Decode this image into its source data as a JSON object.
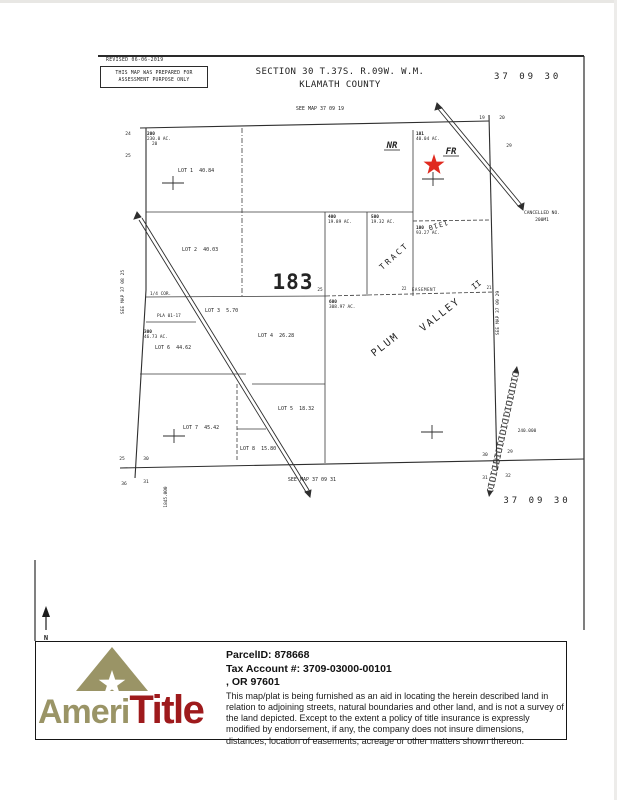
{
  "colors": {
    "ink": "#2e2e2e",
    "logo_olive": "#9a9466",
    "logo_red": "#9e1a1c",
    "star_red": "#e02a1f"
  },
  "header": {
    "revised": "REVISED  06-06-2019",
    "stamp_line1": "THIS MAP WAS PREPARED FOR",
    "stamp_line2": "ASSESSMENT PURPOSE ONLY",
    "title_line1": "SECTION 30 T.37S. R.09W. W.M.",
    "title_line2": "KLAMATH COUNTY",
    "sheet_code_top": "37 09 30"
  },
  "map": {
    "see_map_top": "SEE MAP 37 09 19",
    "see_map_left": "SEE MAP 37 08 25",
    "see_map_right": "SEE MAP 37 09 29",
    "see_map_bottom": "SEE MAP 37 09 31",
    "sheet_code_bottom": "37 09 30",
    "section_number": "183",
    "area_nr": "NR",
    "area_fr": "FR",
    "tract_label": "TRACT",
    "tract_number": "1310",
    "plum": "PLUM",
    "valley": "VALLEY",
    "valley_suffix": "II",
    "easement": "EASEMENT",
    "cancelled_line1": "CANCELLED NO.",
    "cancelled_line2": "200M1",
    "quarter_corner": "1/4 COR.",
    "plat_ref": "PLA 01-17",
    "grid_coord_bottom_left": "1845.000",
    "grid_coord_right": "240.000",
    "north_label": "N",
    "lots": [
      "LOT 1  40.84",
      "LOT 2  40.03",
      "LOT 3  5.70",
      "LOT 4  26.28",
      "LOT 5  18.32",
      "LOT 6  44.62",
      "LOT 7  45.42",
      "LOT 8  15.80"
    ],
    "parcels": [
      {
        "id": "200",
        "acres": "230.0 AC.",
        "note": "20"
      },
      {
        "id": "300",
        "acres": "46.73 AC."
      },
      {
        "id": "400",
        "acres": "19.89 AC."
      },
      {
        "id": "500",
        "acres": "19.32 AC."
      },
      {
        "id": "600",
        "acres": "308.97 AC."
      },
      {
        "id": "100",
        "acres": "93.27 AC."
      },
      {
        "id": "101",
        "acres": "40.04 AC."
      }
    ],
    "corner_numbers": {
      "nw_a": "24",
      "nw_b": "25",
      "n_a": "19",
      "n_b": "20",
      "ne_a": "29",
      "center": "25",
      "ease_a": "22",
      "ease_b": "21",
      "sw_a": "25",
      "sw_b": "30",
      "sw_c": "36",
      "sw_d": "31",
      "se_a": "30",
      "se_b": "29",
      "se_c": "31",
      "se_d": "32"
    }
  },
  "footer": {
    "logo_ameri": "Ameri",
    "logo_title": "Title",
    "parcel_id": "ParcelID: 878668",
    "tax_account": "Tax Account #: 3709-03000-00101",
    "city_state": ",  OR 97601",
    "disclaimer": "This map/plat is being furnished as an aid in locating the herein described land in relation to adjoining streets, natural boundaries and other land, and is not a survey of the land depicted. Except to the extent a policy of title insurance is expressly modified by endorsement, if any, the company does not insure dimensions, distances, location of easements, acreage or other matters shown thereon."
  }
}
